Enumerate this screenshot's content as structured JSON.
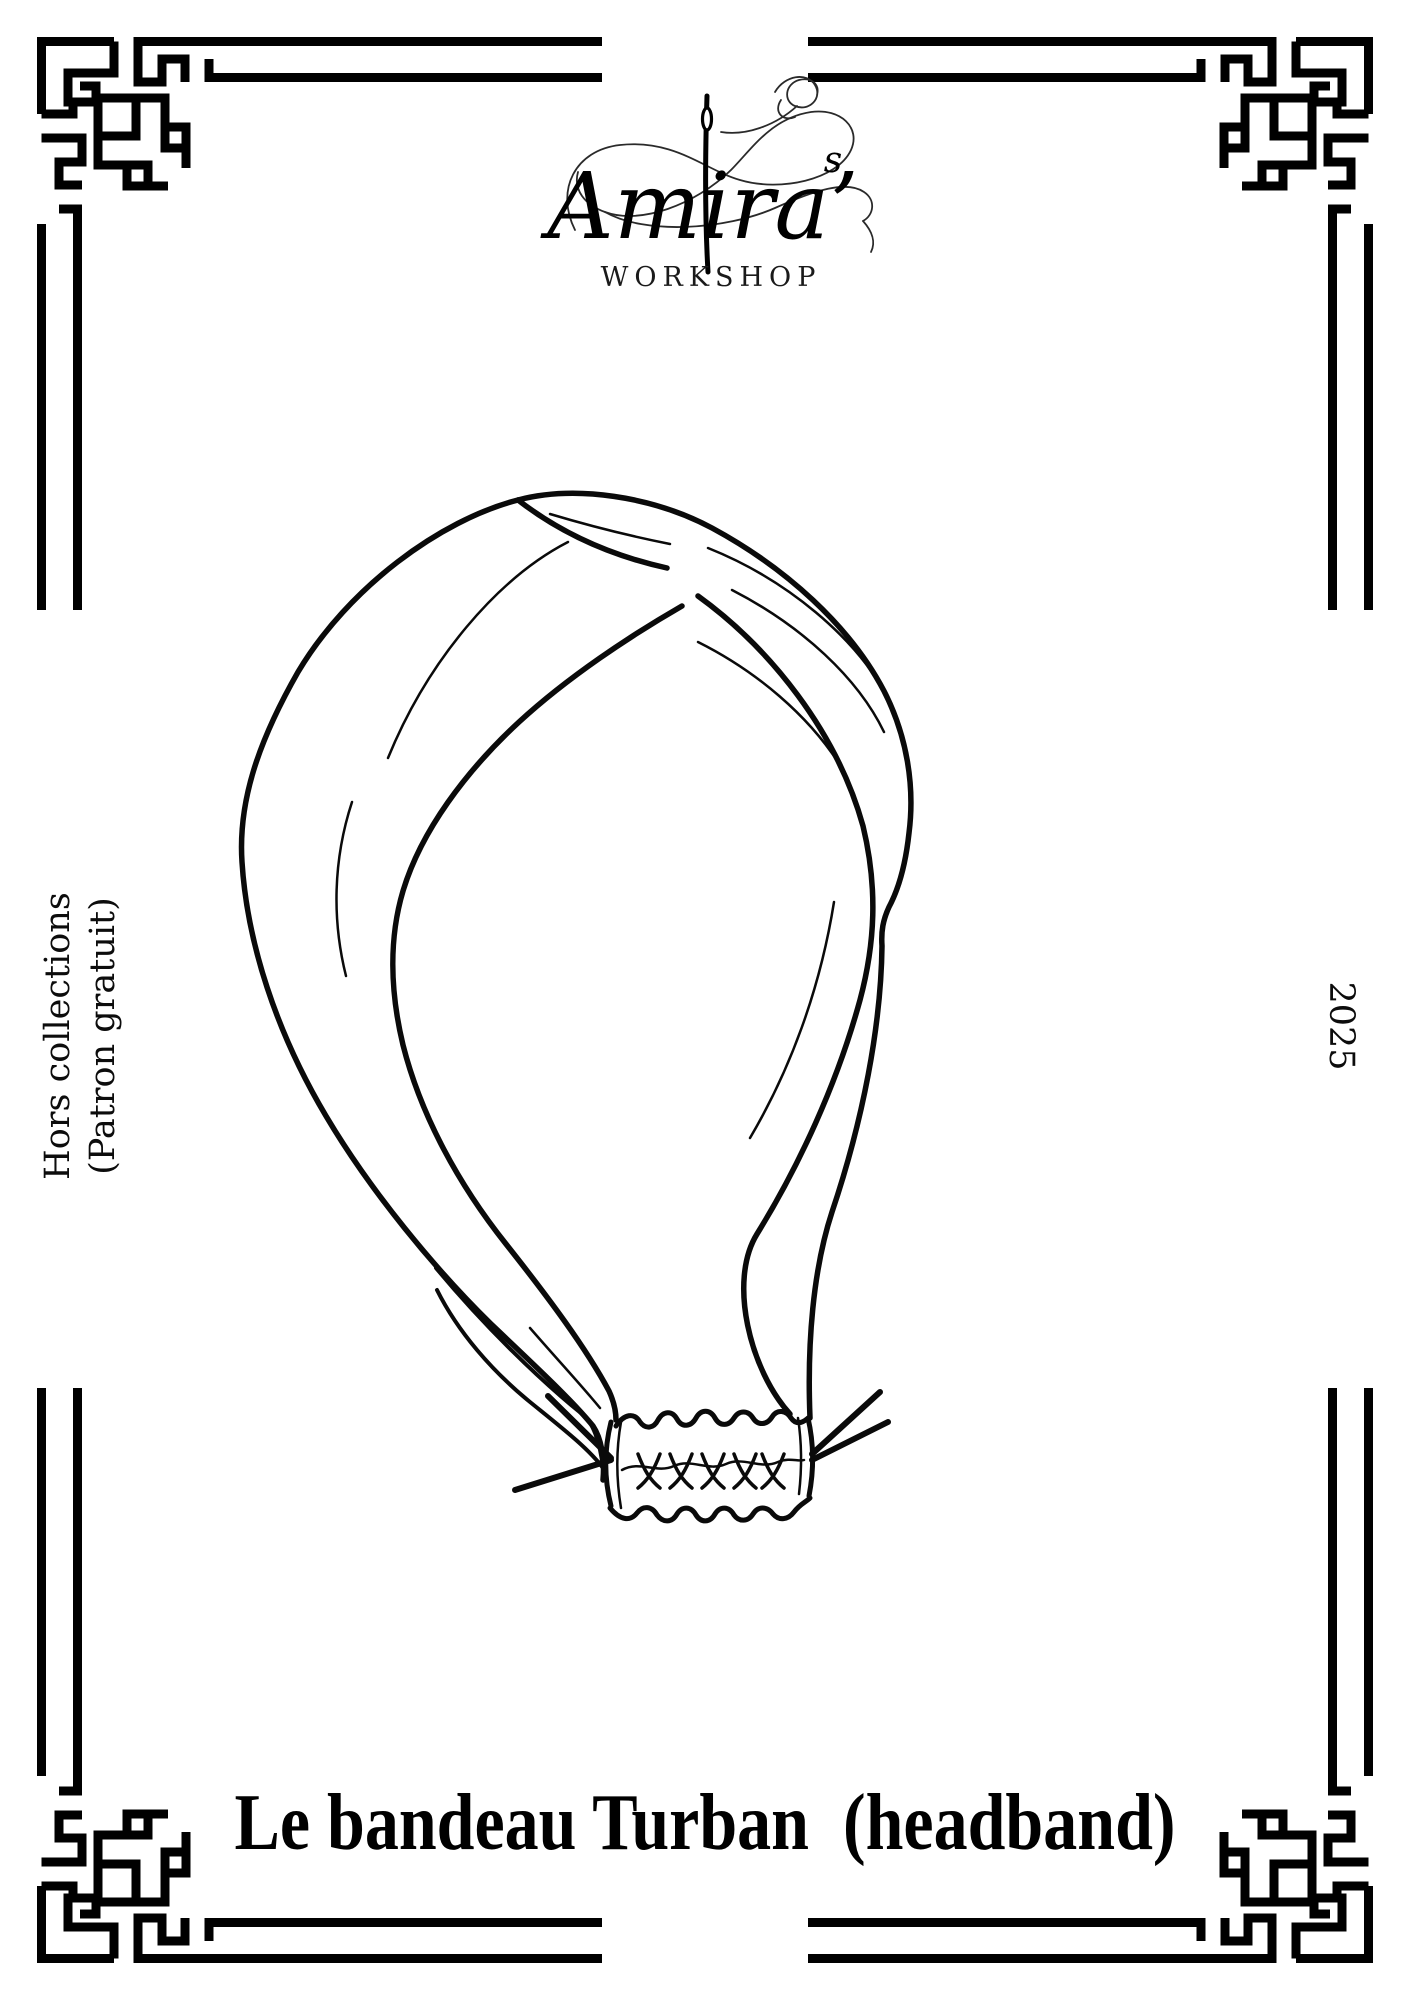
{
  "page": {
    "background": "#ffffff",
    "ink": "#000000"
  },
  "brand": {
    "script_name": "Amira’",
    "script_suffix": "s",
    "wordmark": "WORKSHOP"
  },
  "side_texts": {
    "left_line1": "Hors collections",
    "left_line2": "(Patron gratuit)",
    "right_year": "2025"
  },
  "title": "Le bandeau Turban  (headband)",
  "illustration": {
    "label": "turban-headband-line-drawing"
  },
  "decor": {
    "corner_style": "greek-key-fretwork",
    "border_style": "double-line"
  }
}
